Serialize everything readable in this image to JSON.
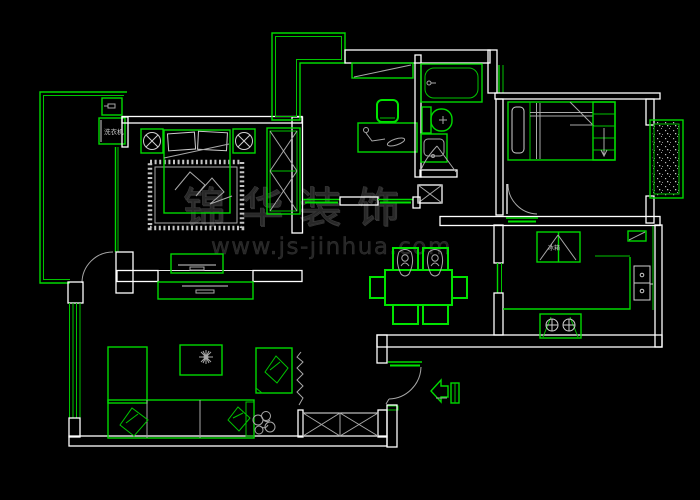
{
  "canvas": {
    "width": 700,
    "height": 500,
    "background": "#000000"
  },
  "colors": {
    "wall": "#ffffff",
    "fixture_green": "#00d900",
    "detail_gray": "#a8a8a8",
    "hatch_dot": "#bdbdbd",
    "watermark": "#282828"
  },
  "labels": {
    "washing_machine": "洗衣机",
    "fridge": "冰箱"
  },
  "watermark": {
    "brand": "锦华装饰",
    "url": "www.js-jinhua.com"
  },
  "fixtures": [
    "balcony-hatch",
    "washing-machine",
    "water-heater",
    "double-bed",
    "nightstand",
    "ceiling-lamp-symbol",
    "rug",
    "wardrobe",
    "dresser-tv",
    "tv-cabinet",
    "sofa",
    "coffee-table",
    "plant",
    "armchair",
    "curtain-zigzag",
    "window-x",
    "desk",
    "desk-lamp",
    "chair",
    "bookshelf",
    "bathtub",
    "toilet",
    "wash-basin",
    "shaft",
    "single-bed",
    "bay-window-hatch",
    "dining-table",
    "dining-chair",
    "fridge",
    "wall-cabinet",
    "kitchen-sink",
    "gas-stove",
    "counter",
    "entry-arrow",
    "door-swing"
  ]
}
